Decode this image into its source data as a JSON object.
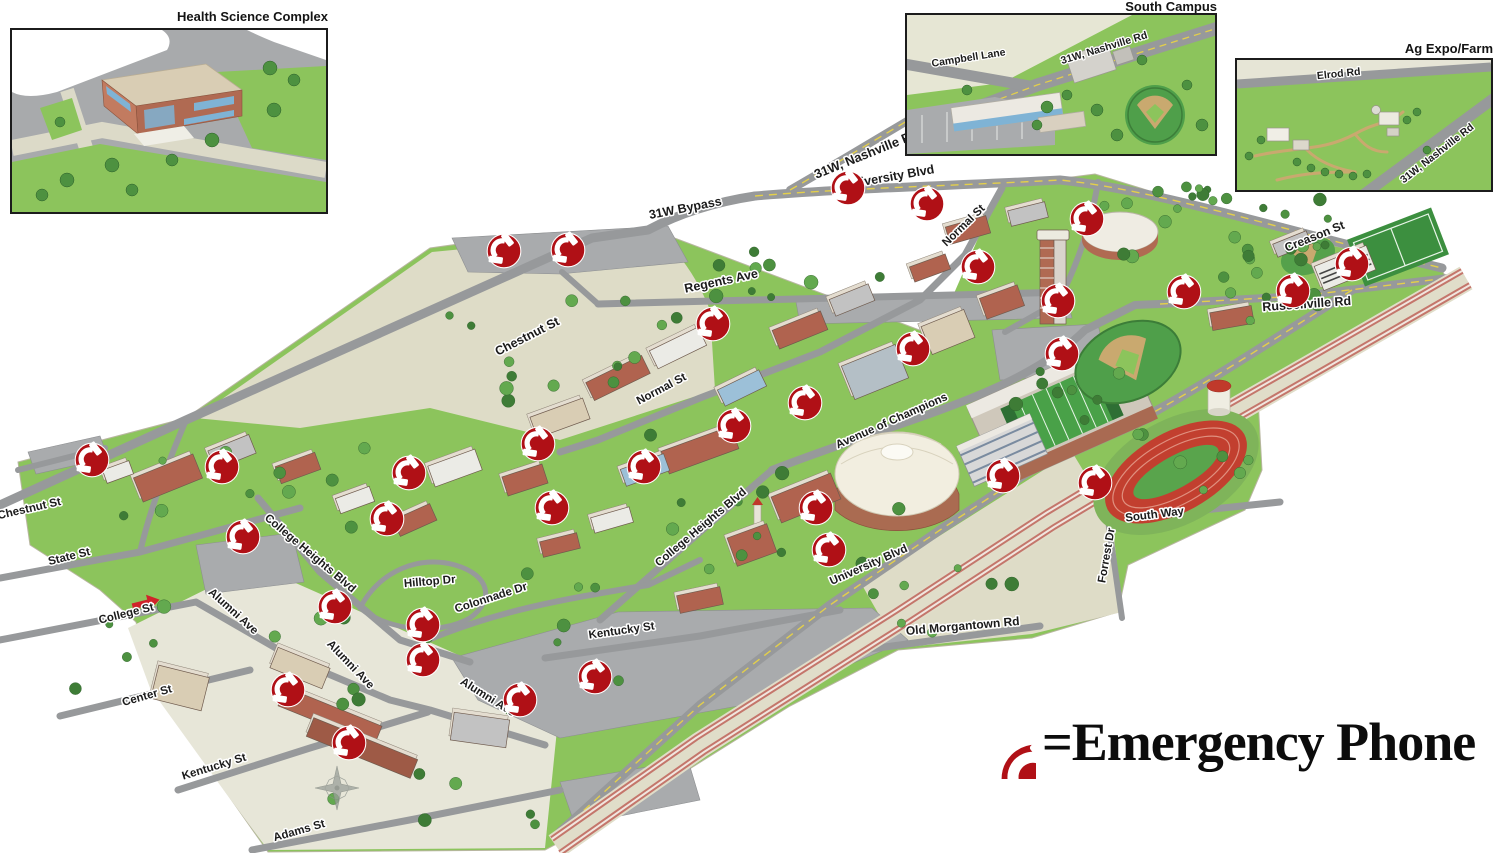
{
  "legend": {
    "label": "=Emergency Phone",
    "marker_color": "#b01016"
  },
  "insets": {
    "health_science": {
      "title": "Health Science Complex",
      "labels": []
    },
    "south_campus": {
      "title": "South Campus",
      "labels": [
        {
          "text": "Campbell Lane",
          "x": 62,
          "y": 46,
          "angle": -9
        },
        {
          "text": "31W, Nashville Rd",
          "x": 198,
          "y": 36,
          "angle": -17
        }
      ]
    },
    "ag_expo": {
      "title": "Ag Expo/Farm",
      "labels": [
        {
          "text": "Elrod Rd",
          "x": 102,
          "y": 17,
          "angle": -6
        },
        {
          "text": "31W, Nashville Rd",
          "x": 202,
          "y": 96,
          "angle": -38
        }
      ]
    }
  },
  "map": {
    "street_labels": [
      {
        "text": "31W, Nashville Rd",
        "x": 868,
        "y": 158,
        "angle": -22,
        "size": 13
      },
      {
        "text": "University Blvd",
        "x": 890,
        "y": 181,
        "angle": -10,
        "size": 12.5
      },
      {
        "text": "31W Bypass",
        "x": 686,
        "y": 212,
        "angle": -11,
        "size": 12.5
      },
      {
        "text": "Creason St",
        "x": 1316,
        "y": 240,
        "angle": -22,
        "size": 12
      },
      {
        "text": "Russellville Rd",
        "x": 1307,
        "y": 308,
        "angle": -4,
        "size": 12.5
      },
      {
        "text": "Regents Ave",
        "x": 722,
        "y": 285,
        "angle": -12,
        "size": 12.5
      },
      {
        "text": "Chestnut St",
        "x": 529,
        "y": 340,
        "angle": -27,
        "size": 12.5
      },
      {
        "text": "Normal St",
        "x": 966,
        "y": 228,
        "angle": -44,
        "size": 11.5
      },
      {
        "text": "Normal St",
        "x": 663,
        "y": 392,
        "angle": -28,
        "size": 11.5
      },
      {
        "text": "Avenue of Champions",
        "x": 893,
        "y": 424,
        "angle": -24,
        "size": 11.5
      },
      {
        "text": "Chestnut St",
        "x": 30,
        "y": 512,
        "angle": -13,
        "size": 11.5
      },
      {
        "text": "State St",
        "x": 70,
        "y": 560,
        "angle": -14,
        "size": 11.5
      },
      {
        "text": "College St",
        "x": 127,
        "y": 617,
        "angle": -14,
        "size": 11.5
      },
      {
        "text": "Alumni Ave",
        "x": 231,
        "y": 614,
        "angle": 42,
        "size": 11.5
      },
      {
        "text": "College Heights Blvd",
        "x": 308,
        "y": 556,
        "angle": 40,
        "size": 11.5
      },
      {
        "text": "Hilltop Dr",
        "x": 430,
        "y": 585,
        "angle": -5,
        "size": 11.5
      },
      {
        "text": "Colonnade Dr",
        "x": 492,
        "y": 601,
        "angle": -18,
        "size": 11.5
      },
      {
        "text": "College Heights Blvd",
        "x": 703,
        "y": 530,
        "angle": -40,
        "size": 11.5
      },
      {
        "text": "Kentucky St",
        "x": 622,
        "y": 634,
        "angle": -8,
        "size": 11.5
      },
      {
        "text": "Center St",
        "x": 148,
        "y": 699,
        "angle": -16,
        "size": 11.5
      },
      {
        "text": "Alumni Ave",
        "x": 348,
        "y": 667,
        "angle": 46,
        "size": 11.5
      },
      {
        "text": "Alumni Ave",
        "x": 486,
        "y": 700,
        "angle": 32,
        "size": 11.5
      },
      {
        "text": "Kentucky St",
        "x": 215,
        "y": 770,
        "angle": -17,
        "size": 11.5
      },
      {
        "text": "Adams St",
        "x": 300,
        "y": 834,
        "angle": -16,
        "size": 11.5
      },
      {
        "text": "University Blvd",
        "x": 870,
        "y": 568,
        "angle": -24,
        "size": 11.5
      },
      {
        "text": "South Way",
        "x": 1155,
        "y": 518,
        "angle": -7,
        "size": 11.5
      },
      {
        "text": "Forrest Dr",
        "x": 1110,
        "y": 556,
        "angle": -80,
        "size": 11.5
      },
      {
        "text": "Old Morgantown Rd",
        "x": 963,
        "y": 630,
        "angle": -5,
        "size": 12
      }
    ],
    "phone_markers": [
      [
        848,
        188
      ],
      [
        927,
        204
      ],
      [
        1087,
        219
      ],
      [
        978,
        267
      ],
      [
        1058,
        301
      ],
      [
        1184,
        292
      ],
      [
        1293,
        291
      ],
      [
        1352,
        264
      ],
      [
        504,
        251
      ],
      [
        568,
        250
      ],
      [
        713,
        324
      ],
      [
        913,
        349
      ],
      [
        1062,
        354
      ],
      [
        805,
        403
      ],
      [
        734,
        426
      ],
      [
        538,
        444
      ],
      [
        644,
        467
      ],
      [
        92,
        460
      ],
      [
        222,
        467
      ],
      [
        409,
        473
      ],
      [
        552,
        508
      ],
      [
        387,
        519
      ],
      [
        243,
        537
      ],
      [
        1003,
        476
      ],
      [
        1095,
        483
      ],
      [
        816,
        508
      ],
      [
        829,
        550
      ],
      [
        335,
        607
      ],
      [
        423,
        625
      ],
      [
        423,
        660
      ],
      [
        288,
        690
      ],
      [
        595,
        677
      ],
      [
        520,
        700
      ],
      [
        349,
        743
      ]
    ]
  }
}
